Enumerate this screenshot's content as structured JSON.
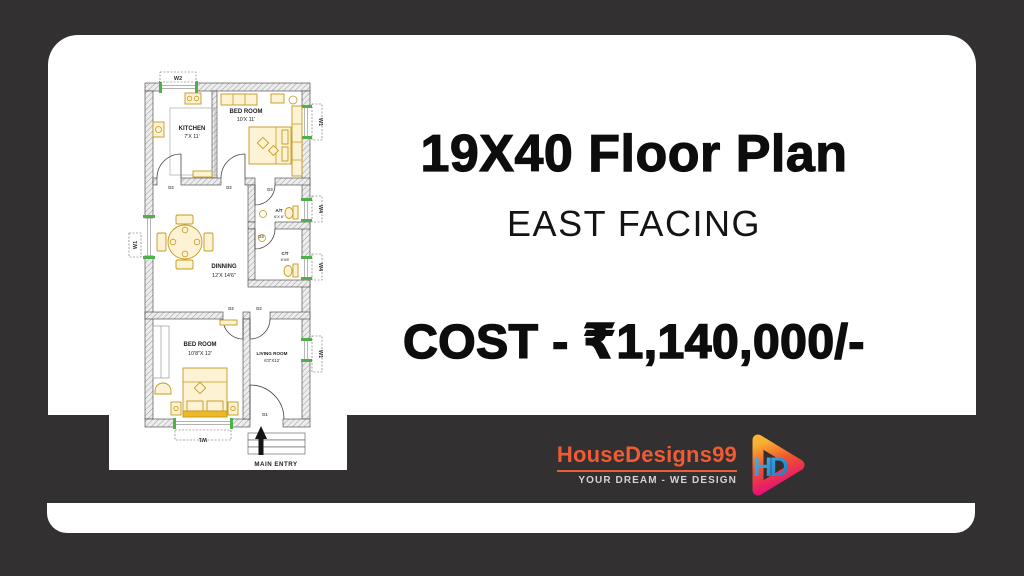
{
  "headline": {
    "title": "19X40 Floor Plan",
    "subtitle": "EAST FACING",
    "cost": "COST - ₹1,140,000/-"
  },
  "brand": {
    "name": "HouseDesigns99",
    "tagline": "YOUR DREAM - WE DESIGN",
    "monogram": "HD",
    "name_color": "#ee5b35",
    "tagline_color": "#d3d2d2"
  },
  "plan": {
    "rooms": {
      "kitchen": {
        "name": "KITCHEN",
        "size": "7'X 11'"
      },
      "bedroom1": {
        "name": "BED ROOM",
        "size": "10'X 11'"
      },
      "toilet_attached": {
        "name": "A/T",
        "size": "6'X 6'"
      },
      "toilet_common": {
        "name": "C/T",
        "size": "6'X8'"
      },
      "dining": {
        "name": "DINNING",
        "size": "12'X 14'6\""
      },
      "bedroom2": {
        "name": "BED ROOM",
        "size": "10'8\"X 12'"
      },
      "living": {
        "name": "LIVING ROOM",
        "size": "6'3\"X12'"
      }
    },
    "labels": {
      "w1": "W1",
      "w2": "W2",
      "w4": "W4",
      "d1": "D1",
      "d2": "D2",
      "d3": "D3",
      "main_entry": "MAIN ENTRY"
    }
  },
  "colors": {
    "background": "#323031",
    "card": "#ffffff",
    "text": "#0d0d0d",
    "plan_furniture": "#c49a1e",
    "plan_window_green": "#4db04b",
    "logo_gradient_top": "#f9b233",
    "logo_gradient_mid": "#f0542c",
    "logo_gradient_bottom": "#e5097f",
    "logo_monogram_blue": "#2f9ae0"
  }
}
